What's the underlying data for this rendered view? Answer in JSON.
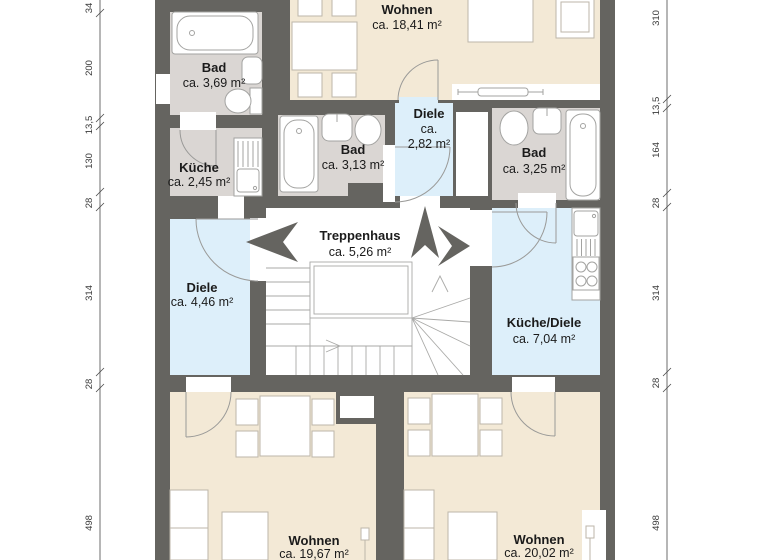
{
  "rooms": {
    "bad_top_left": {
      "name": "Bad",
      "area": "ca. 3,69 m²"
    },
    "kueche": {
      "name": "Küche",
      "area": "ca. 2,45 m²"
    },
    "wohnen_top": {
      "name": "Wohnen",
      "area": "ca. 18,41 m²"
    },
    "bad_mid": {
      "name": "Bad",
      "area": "ca. 3,13 m²"
    },
    "diele_small": {
      "name": "Diele",
      "area_line1": "ca.",
      "area_line2": "2,82 m²"
    },
    "bad_right": {
      "name": "Bad",
      "area": "ca. 3,25 m²"
    },
    "treppenhaus": {
      "name": "Treppenhaus",
      "area": "ca. 5,26 m²"
    },
    "diele_left": {
      "name": "Diele",
      "area": "ca. 4,46 m²"
    },
    "kueche_diele": {
      "name": "Küche/Diele",
      "area": "ca. 7,04 m²"
    },
    "wohnen_bottom_left": {
      "name": "Wohnen",
      "area": "ca. 19,67 m²"
    },
    "wohnen_bottom_right": {
      "name": "Wohnen",
      "area": "ca. 20,02 m²"
    }
  },
  "dimensions": {
    "left": [
      "34",
      "200",
      "13,5",
      "130",
      "28",
      "314",
      "28",
      "498"
    ],
    "right": [
      "310",
      "13,5",
      "164",
      "28",
      "314",
      "28",
      "498"
    ]
  },
  "colors": {
    "wall": "#656460",
    "living_room": "#f3e9d6",
    "bathroom": "#dad6d3",
    "hallway": "#ddeffa",
    "background": "#ffffff"
  }
}
